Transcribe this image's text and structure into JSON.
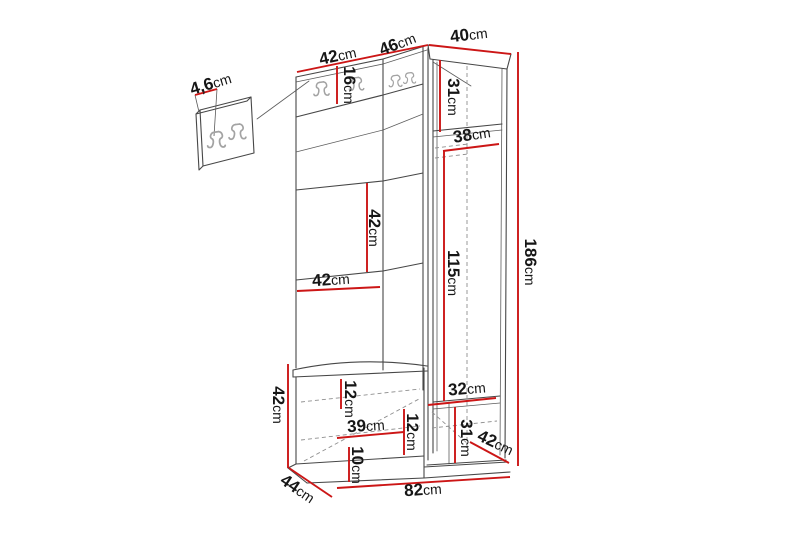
{
  "diagram": {
    "type": "furniture-dimension-diagram",
    "subject": "Hallway storage unit with coat hook panels, open shelves, seat bench and corner wardrobe",
    "unit": "cm",
    "colors": {
      "background": "#ffffff",
      "outline": "#474747",
      "dimension_line": "#cc1616",
      "label_text": "#161616",
      "hook_icon": "#a3a3a3",
      "hidden_edge": "#8f8f8f"
    },
    "detail_panel": {
      "description": "wall-mounted hook panel detail",
      "hook_count": 2,
      "thickness_label": "4,6cm"
    },
    "main_unit_hook_count": 4,
    "dimensions": [
      {
        "id": "panel-thickness",
        "value": "4,6",
        "unit": "cm",
        "x": 211,
        "y": 85,
        "rotation": -17,
        "line": [
          195,
          95,
          217,
          89
        ]
      },
      {
        "id": "top-width-left",
        "value": "42",
        "unit": "cm",
        "x": 338,
        "y": 57,
        "rotation": -12,
        "line": [
          297,
          72,
          384,
          54
        ]
      },
      {
        "id": "top-width-middle",
        "value": "46",
        "unit": "cm",
        "x": 398,
        "y": 45,
        "rotation": -21,
        "line": [
          384,
          54,
          428,
          45
        ]
      },
      {
        "id": "top-width-right",
        "value": "40",
        "unit": "cm",
        "x": 469,
        "y": 36,
        "rotation": -7,
        "line": [
          429,
          45,
          511,
          54
        ]
      },
      {
        "id": "hook-board-height",
        "value": "16",
        "unit": "cm",
        "x": 348,
        "y": 85,
        "rotation": 90,
        "line": [
          337,
          66,
          337,
          104
        ]
      },
      {
        "id": "wardrobe-top-section-height",
        "value": "31",
        "unit": "cm",
        "x": 452,
        "y": 97,
        "rotation": 90,
        "line": [
          440,
          60,
          440,
          132
        ]
      },
      {
        "id": "wardrobe-top-depth",
        "value": "38",
        "unit": "cm",
        "x": 472,
        "y": 136,
        "rotation": -9,
        "line": [
          443,
          151,
          499,
          144
        ]
      },
      {
        "id": "shelf-section-height",
        "value": "42",
        "unit": "cm",
        "x": 373,
        "y": 228,
        "rotation": 90,
        "line": [
          367,
          183,
          367,
          272
        ]
      },
      {
        "id": "shelf-width",
        "value": "42",
        "unit": "cm",
        "x": 331,
        "y": 281,
        "rotation": -4,
        "line": [
          297,
          291,
          380,
          287
        ]
      },
      {
        "id": "wardrobe-interior-height",
        "value": "115",
        "unit": "cm",
        "x": 452,
        "y": 273,
        "rotation": 90,
        "line": [
          444,
          151,
          444,
          401
        ]
      },
      {
        "id": "total-height",
        "value": "186",
        "unit": "cm",
        "x": 529,
        "y": 262,
        "rotation": 90,
        "line": [
          518,
          52,
          518,
          466
        ]
      },
      {
        "id": "bench-height",
        "value": "42",
        "unit": "cm",
        "x": 277,
        "y": 405,
        "rotation": 90,
        "line": [
          288,
          364,
          288,
          468
        ]
      },
      {
        "id": "bench-top-section-height",
        "value": "12",
        "unit": "cm",
        "x": 349,
        "y": 399,
        "rotation": 90,
        "line": [
          341,
          379,
          341,
          409
        ]
      },
      {
        "id": "wardrobe-bottom-width",
        "value": "32",
        "unit": "cm",
        "x": 467,
        "y": 390,
        "rotation": -5,
        "line": [
          428,
          405,
          496,
          398
        ]
      },
      {
        "id": "bench-interior-width",
        "value": "39",
        "unit": "cm",
        "x": 366,
        "y": 427,
        "rotation": -4,
        "line": [
          337,
          438,
          404,
          432
        ]
      },
      {
        "id": "bench-mid-section-height",
        "value": "12",
        "unit": "cm",
        "x": 411,
        "y": 432,
        "rotation": 90,
        "line": [
          404,
          409,
          404,
          455
        ]
      },
      {
        "id": "wardrobe-bottom-section-height",
        "value": "31",
        "unit": "cm",
        "x": 465,
        "y": 438,
        "rotation": 90,
        "line": [
          455,
          407,
          455,
          463
        ]
      },
      {
        "id": "wardrobe-bottom-depth",
        "value": "42",
        "unit": "cm",
        "x": 495,
        "y": 444,
        "rotation": 25,
        "line": [
          470,
          442,
          509,
          463
        ]
      },
      {
        "id": "bench-bottom-section-height",
        "value": "10",
        "unit": "cm",
        "x": 356,
        "y": 465,
        "rotation": 90,
        "line": [
          349,
          447,
          349,
          482
        ]
      },
      {
        "id": "bench-depth",
        "value": "44",
        "unit": "cm",
        "x": 297,
        "y": 490,
        "rotation": 34,
        "line": [
          289,
          468,
          332,
          497
        ]
      },
      {
        "id": "total-width",
        "value": "82",
        "unit": "cm",
        "x": 423,
        "y": 491,
        "rotation": -4,
        "line": [
          337,
          488,
          510,
          477
        ]
      }
    ]
  }
}
